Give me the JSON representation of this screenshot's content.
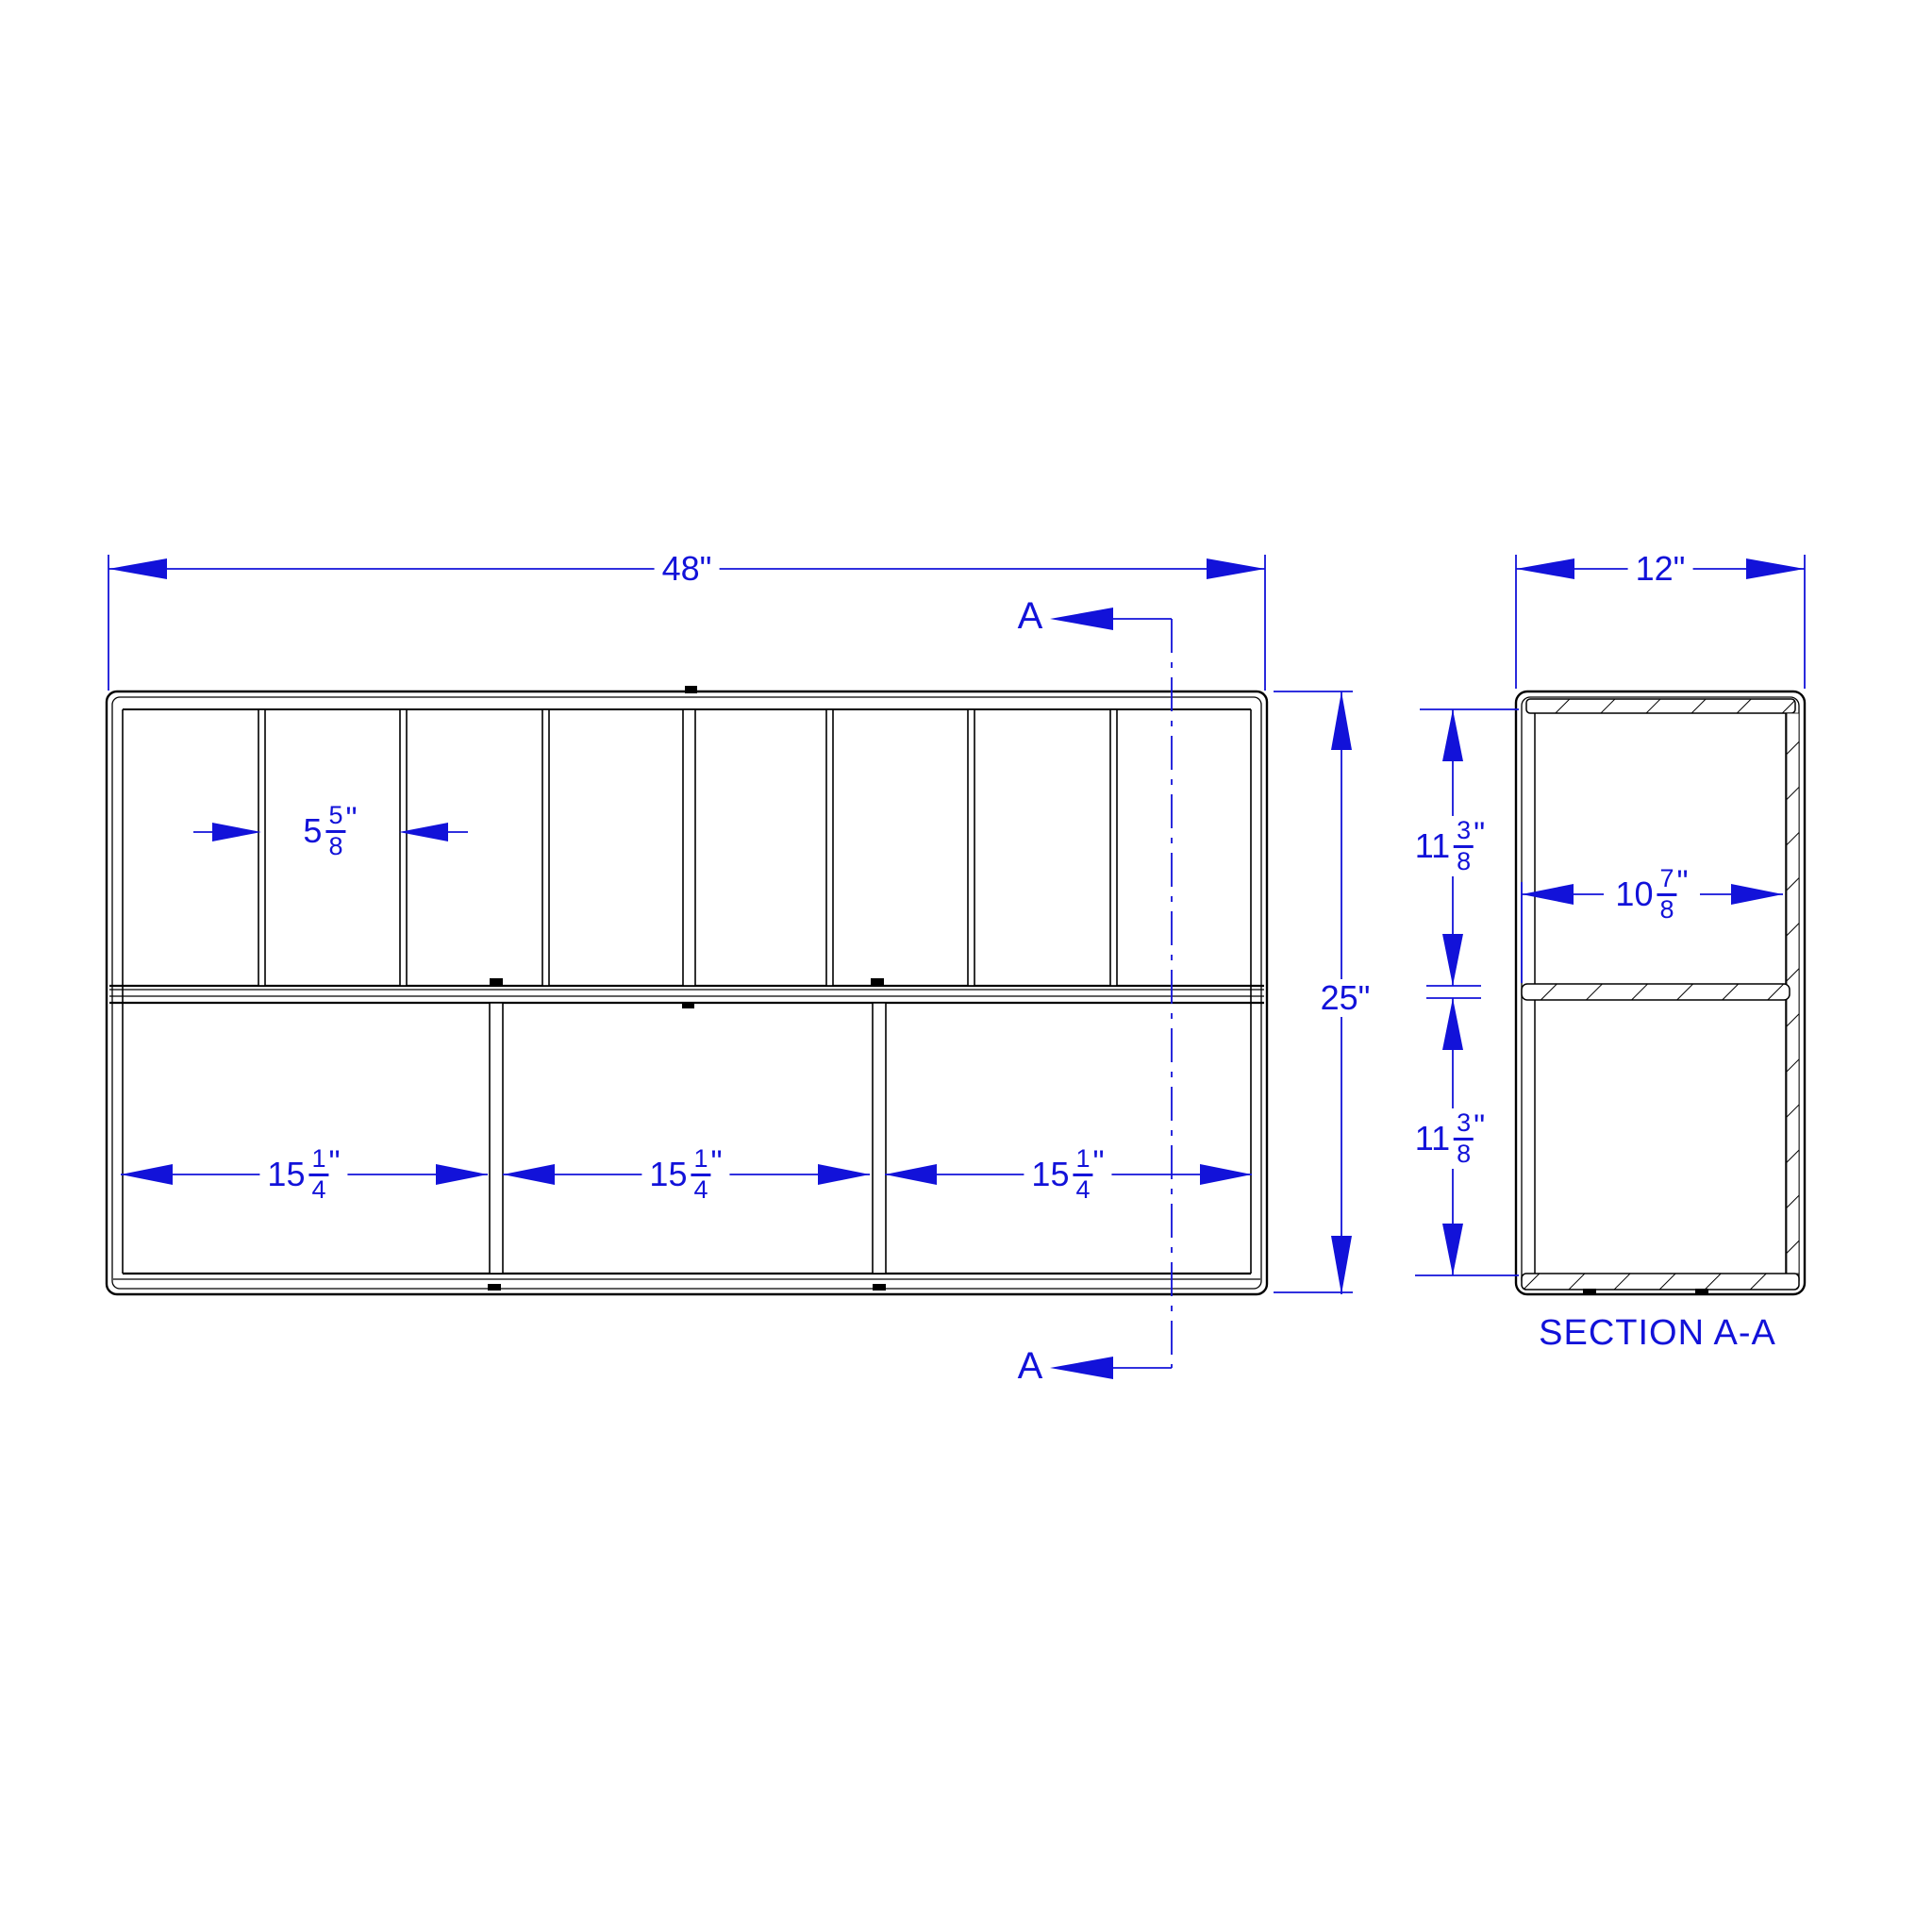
{
  "colors": {
    "dimension_blue": "#1212d9",
    "line_black": "#000000",
    "background": "#ffffff"
  },
  "front_view": {
    "width_label": "48\"",
    "height_label": "25\"",
    "top_compartment_width": {
      "whole": "5",
      "num": "5",
      "den": "8",
      "unit": "\""
    },
    "bottom_compartments": [
      {
        "whole": "15",
        "num": "1",
        "den": "4",
        "unit": "\""
      },
      {
        "whole": "15",
        "num": "1",
        "den": "4",
        "unit": "\""
      },
      {
        "whole": "15",
        "num": "1",
        "den": "4",
        "unit": "\""
      }
    ],
    "cut_label_top": "A",
    "cut_label_bottom": "A"
  },
  "section_view": {
    "title": "SECTION A-A",
    "width_label": "12\"",
    "inner_width": {
      "whole": "10",
      "num": "7",
      "den": "8",
      "unit": "\""
    },
    "upper_height": {
      "whole": "11",
      "num": "3",
      "den": "8",
      "unit": "\""
    },
    "lower_height": {
      "whole": "11",
      "num": "3",
      "den": "8",
      "unit": "\""
    }
  }
}
